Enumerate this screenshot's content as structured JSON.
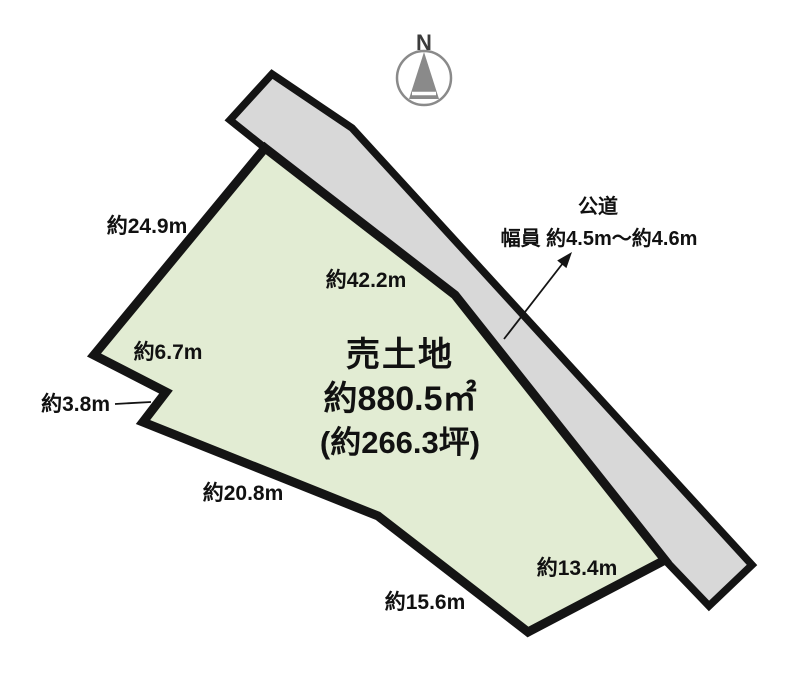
{
  "compass": {
    "north_label": "N"
  },
  "parcel": {
    "title": "売土地",
    "area_m2": "約880.5㎡",
    "area_tsubo": "(約266.3坪)",
    "edge_labels": {
      "north": "約24.9m",
      "road_side": "約42.2m",
      "west_upper": "約6.7m",
      "west_notch": "約3.8m",
      "southwest": "約20.8m",
      "south": "約15.6m",
      "southeast": "約13.4m"
    }
  },
  "road": {
    "name": "公道",
    "width": "幅員 約4.5m〜約4.6m"
  },
  "colors": {
    "parcel_fill": "#e2ecd3",
    "road_fill": "#d8d8d8",
    "outline": "#141414",
    "text": "#111111",
    "compass_gray": "#8a8a8a",
    "compass_text": "#3c3c3c"
  }
}
